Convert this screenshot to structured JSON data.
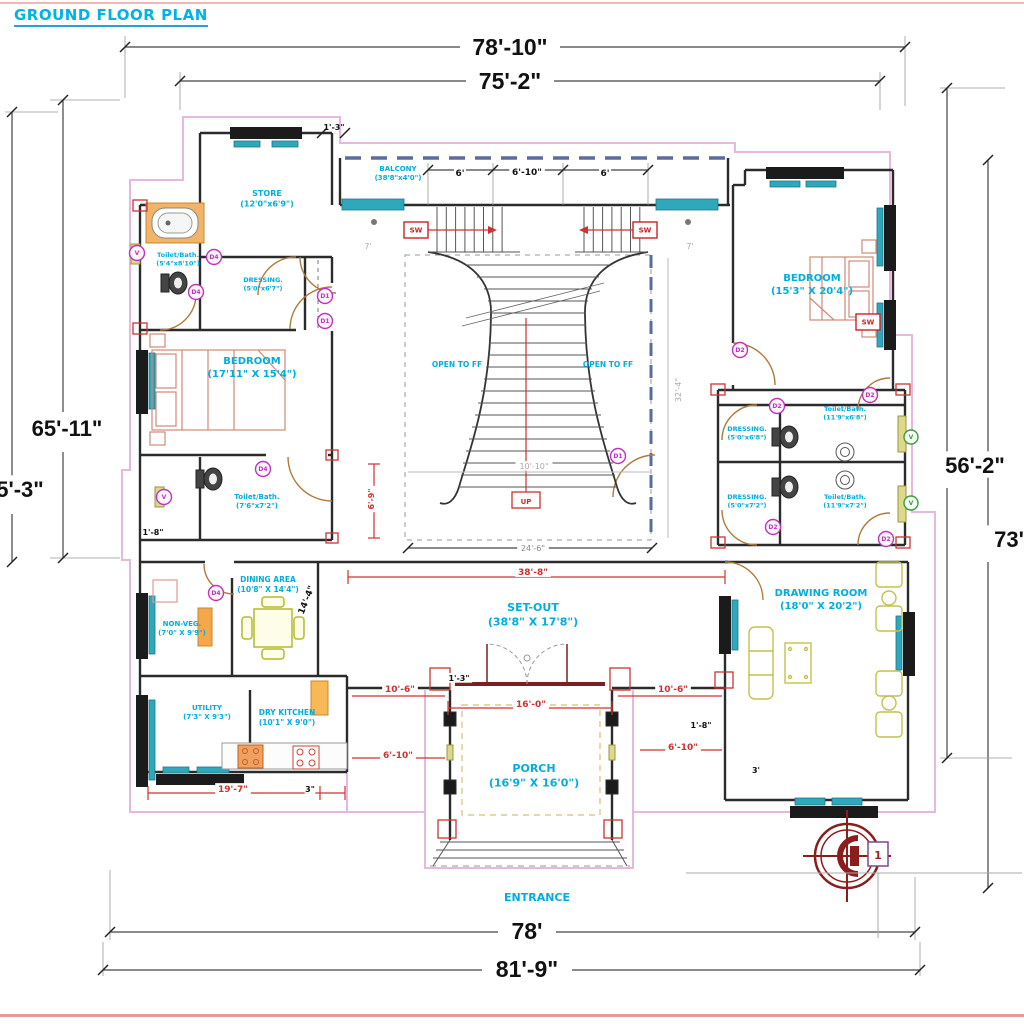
{
  "title": "GROUND FLOOR PLAN",
  "colors": {
    "room_label": "#00aede",
    "dim_black": "#111111",
    "dim_red": "#d03030",
    "dim_gray": "#aaaaaa",
    "tag_magenta": "#bb35bb",
    "tag_green": "#3e9b3e",
    "wall": "#2b2b2b",
    "boundary_pink": "#e6b8de"
  },
  "rooms": [
    {
      "name": "STORE",
      "dims": "(12'0\"x6'9\")",
      "x": 267,
      "y": 196,
      "size": 8
    },
    {
      "name": "BALCONY",
      "dims": "(38'8\"x4'0\")",
      "x": 398,
      "y": 171,
      "size": 7
    },
    {
      "name": "BEDROOM",
      "dims": "(15'3\" X 20'4\")",
      "x": 812,
      "y": 281,
      "size": 10
    },
    {
      "name": "BEDROOM",
      "dims": "(17'11\" X 15'4\")",
      "x": 252,
      "y": 364,
      "size": 10
    },
    {
      "name": "Toilet/Bath.",
      "dims": "(5'4\"x8'10\")",
      "x": 178,
      "y": 257,
      "size": 6.5
    },
    {
      "name": "DRESSING.",
      "dims": "(5'0\"x6'7\")",
      "x": 263,
      "y": 282,
      "size": 6.5
    },
    {
      "name": "Toilet/Bath.",
      "dims": "(7'6\"x7'2\")",
      "x": 257,
      "y": 499,
      "size": 7
    },
    {
      "name": "DRESSING.",
      "dims": "(5'0\"x6'8\")",
      "x": 747,
      "y": 431,
      "size": 6.5
    },
    {
      "name": "Toilet/Bath.",
      "dims": "(11'9\"x6'8\")",
      "x": 845,
      "y": 411,
      "size": 6.5
    },
    {
      "name": "DRESSING.",
      "dims": "(5'0\"x7'2\")",
      "x": 747,
      "y": 499,
      "size": 6.5
    },
    {
      "name": "Toilet/Bath.",
      "dims": "(11'9\"x7'2\")",
      "x": 845,
      "y": 499,
      "size": 6.5
    },
    {
      "name": "DINING AREA",
      "dims": "(10'8\" X 14'4\")",
      "x": 268,
      "y": 582,
      "size": 7.5
    },
    {
      "name": "NON-VEG.",
      "dims": "(7'0\" X 9'9\")",
      "x": 182,
      "y": 626,
      "size": 7
    },
    {
      "name": "UTILITY",
      "dims": "(7'3\" X 9'3\")",
      "x": 207,
      "y": 710,
      "size": 7
    },
    {
      "name": "DRY KITCHEN",
      "dims": "(10'1\" X 9'0\")",
      "x": 287,
      "y": 715,
      "size": 7.5
    },
    {
      "name": "SET-OUT",
      "dims": "(38'8\" X 17'8\")",
      "x": 533,
      "y": 611,
      "size": 11
    },
    {
      "name": "PORCH",
      "dims": "(16'9\" X 16'0\")",
      "x": 534,
      "y": 772,
      "size": 11
    },
    {
      "name": "DRAWING ROOM",
      "dims": "(18'0\" X 20'2\")",
      "x": 821,
      "y": 596,
      "size": 10
    },
    {
      "name": "OPEN TO FF",
      "dims": "",
      "x": 457,
      "y": 367,
      "size": 7.5
    },
    {
      "name": "OPEN TO FF",
      "dims": "",
      "x": 608,
      "y": 367,
      "size": 7.5
    },
    {
      "name": "ENTRANCE",
      "dims": "",
      "x": 537,
      "y": 901,
      "size": 11
    }
  ],
  "annotations": [
    {
      "t": "78'-10\"",
      "x": 510,
      "y": 55,
      "c": "#111111",
      "s": 23,
      "b": 1
    },
    {
      "t": "75'-2\"",
      "x": 510,
      "y": 89,
      "c": "#111111",
      "s": 23,
      "b": 1
    },
    {
      "t": "65'-11\"",
      "x": 67,
      "y": 436,
      "c": "#111111",
      "s": 22,
      "b": 1,
      "bg": 1
    },
    {
      "t": "5'-3\"",
      "x": 20,
      "y": 497,
      "c": "#111111",
      "s": 22,
      "b": 1,
      "bg": 1
    },
    {
      "t": "56'-2\"",
      "x": 975,
      "y": 473,
      "c": "#111111",
      "s": 22,
      "b": 1,
      "bg": 1
    },
    {
      "t": "73'",
      "x": 1009,
      "y": 547,
      "c": "#111111",
      "s": 22,
      "b": 1,
      "bg": 1
    },
    {
      "t": "78'",
      "x": 527,
      "y": 939,
      "c": "#111111",
      "s": 23,
      "b": 1
    },
    {
      "t": "81'-9\"",
      "x": 527,
      "y": 977,
      "c": "#111111",
      "s": 23,
      "b": 1
    },
    {
      "t": "6'",
      "x": 460,
      "y": 176,
      "c": "#111111",
      "s": 9,
      "b": 1,
      "bg": 1
    },
    {
      "t": "6'-10\"",
      "x": 527,
      "y": 175,
      "c": "#111111",
      "s": 9,
      "b": 1,
      "bg": 1
    },
    {
      "t": "6'",
      "x": 605,
      "y": 176,
      "c": "#111111",
      "s": 9,
      "b": 1,
      "bg": 1
    },
    {
      "t": "1'-3\"",
      "x": 334,
      "y": 130,
      "c": "#111111",
      "s": 8,
      "b": 1
    },
    {
      "t": "7'",
      "x": 368,
      "y": 249,
      "c": "#aaaaaa",
      "s": 8
    },
    {
      "t": "7'",
      "x": 690,
      "y": 249,
      "c": "#aaaaaa",
      "s": 8
    },
    {
      "t": "32'-4\"",
      "x": 681,
      "y": 390,
      "c": "#aaaaaa",
      "s": 8,
      "r": -90
    },
    {
      "t": "10'-10\"",
      "x": 534,
      "y": 469,
      "c": "#aaaaaa",
      "s": 8,
      "bg": 1
    },
    {
      "t": "24'-6\"",
      "x": 533,
      "y": 551,
      "c": "#888888",
      "s": 8,
      "bg": 1
    },
    {
      "t": "6'-9\"",
      "x": 374,
      "y": 499,
      "c": "#d03030",
      "s": 8,
      "b": 1,
      "r": -90,
      "bg": 1
    },
    {
      "t": "1'-8\"",
      "x": 153,
      "y": 535,
      "c": "#111111",
      "s": 8,
      "b": 1
    },
    {
      "t": "14'-4\"",
      "x": 309,
      "y": 601,
      "c": "#111111",
      "s": 9,
      "b": 1,
      "r": -68
    },
    {
      "t": "38'-8\"",
      "x": 533,
      "y": 575,
      "c": "#d03030",
      "s": 9,
      "b": 1,
      "bg": 1
    },
    {
      "t": "16'-0\"",
      "x": 531,
      "y": 707,
      "c": "#d03030",
      "s": 9,
      "b": 1,
      "bg": 1
    },
    {
      "t": "10'-6\"",
      "x": 400,
      "y": 692,
      "c": "#d03030",
      "s": 9,
      "b": 1,
      "bg": 1
    },
    {
      "t": "10'-6\"",
      "x": 673,
      "y": 692,
      "c": "#d03030",
      "s": 9,
      "b": 1,
      "bg": 1
    },
    {
      "t": "6'-10\"",
      "x": 398,
      "y": 758,
      "c": "#d03030",
      "s": 9,
      "b": 1,
      "bg": 1
    },
    {
      "t": "6'-10\"",
      "x": 683,
      "y": 750,
      "c": "#d03030",
      "s": 9,
      "b": 1,
      "bg": 1
    },
    {
      "t": "19'-7\"",
      "x": 233,
      "y": 792,
      "c": "#d03030",
      "s": 9,
      "b": 1,
      "bg": 1
    },
    {
      "t": "3\"",
      "x": 310,
      "y": 792,
      "c": "#111111",
      "s": 8,
      "b": 1,
      "bg": 1
    },
    {
      "t": "1'-3\"",
      "x": 459,
      "y": 681,
      "c": "#111111",
      "s": 8,
      "b": 1,
      "bg": 1
    },
    {
      "t": "1'-8\"",
      "x": 701,
      "y": 728,
      "c": "#111111",
      "s": 8,
      "b": 1
    },
    {
      "t": "3'",
      "x": 756,
      "y": 773,
      "c": "#111111",
      "s": 8,
      "b": 1
    },
    {
      "t": "UP",
      "x": 526,
      "y": 504,
      "c": "#d03030",
      "s": 7,
      "b": 1
    },
    {
      "t": "1",
      "x": 878,
      "y": 859,
      "c": "#aa2222",
      "s": 11,
      "b": 1
    }
  ],
  "door_tags": [
    {
      "l": "V",
      "x": 137,
      "y": 253
    },
    {
      "l": "D4",
      "x": 214,
      "y": 257
    },
    {
      "l": "D4",
      "x": 196,
      "y": 292
    },
    {
      "l": "D1",
      "x": 325,
      "y": 296
    },
    {
      "l": "D1",
      "x": 325,
      "y": 321
    },
    {
      "l": "D4",
      "x": 263,
      "y": 469
    },
    {
      "l": "V",
      "x": 164,
      "y": 497
    },
    {
      "l": "D1",
      "x": 618,
      "y": 456
    },
    {
      "l": "D4",
      "x": 216,
      "y": 593
    },
    {
      "l": "D2",
      "x": 740,
      "y": 350
    },
    {
      "l": "D2",
      "x": 777,
      "y": 406
    },
    {
      "l": "D2",
      "x": 870,
      "y": 395
    },
    {
      "l": "D2",
      "x": 773,
      "y": 527
    },
    {
      "l": "D2",
      "x": 886,
      "y": 539
    }
  ],
  "green_tags": [
    {
      "l": "V",
      "x": 911,
      "y": 437
    },
    {
      "l": "V",
      "x": 911,
      "y": 503
    }
  ],
  "window_tags": [
    {
      "l": "SW",
      "x": 416,
      "y": 230
    },
    {
      "l": "SW",
      "x": 645,
      "y": 230
    },
    {
      "l": "SW",
      "x": 868,
      "y": 322
    }
  ]
}
